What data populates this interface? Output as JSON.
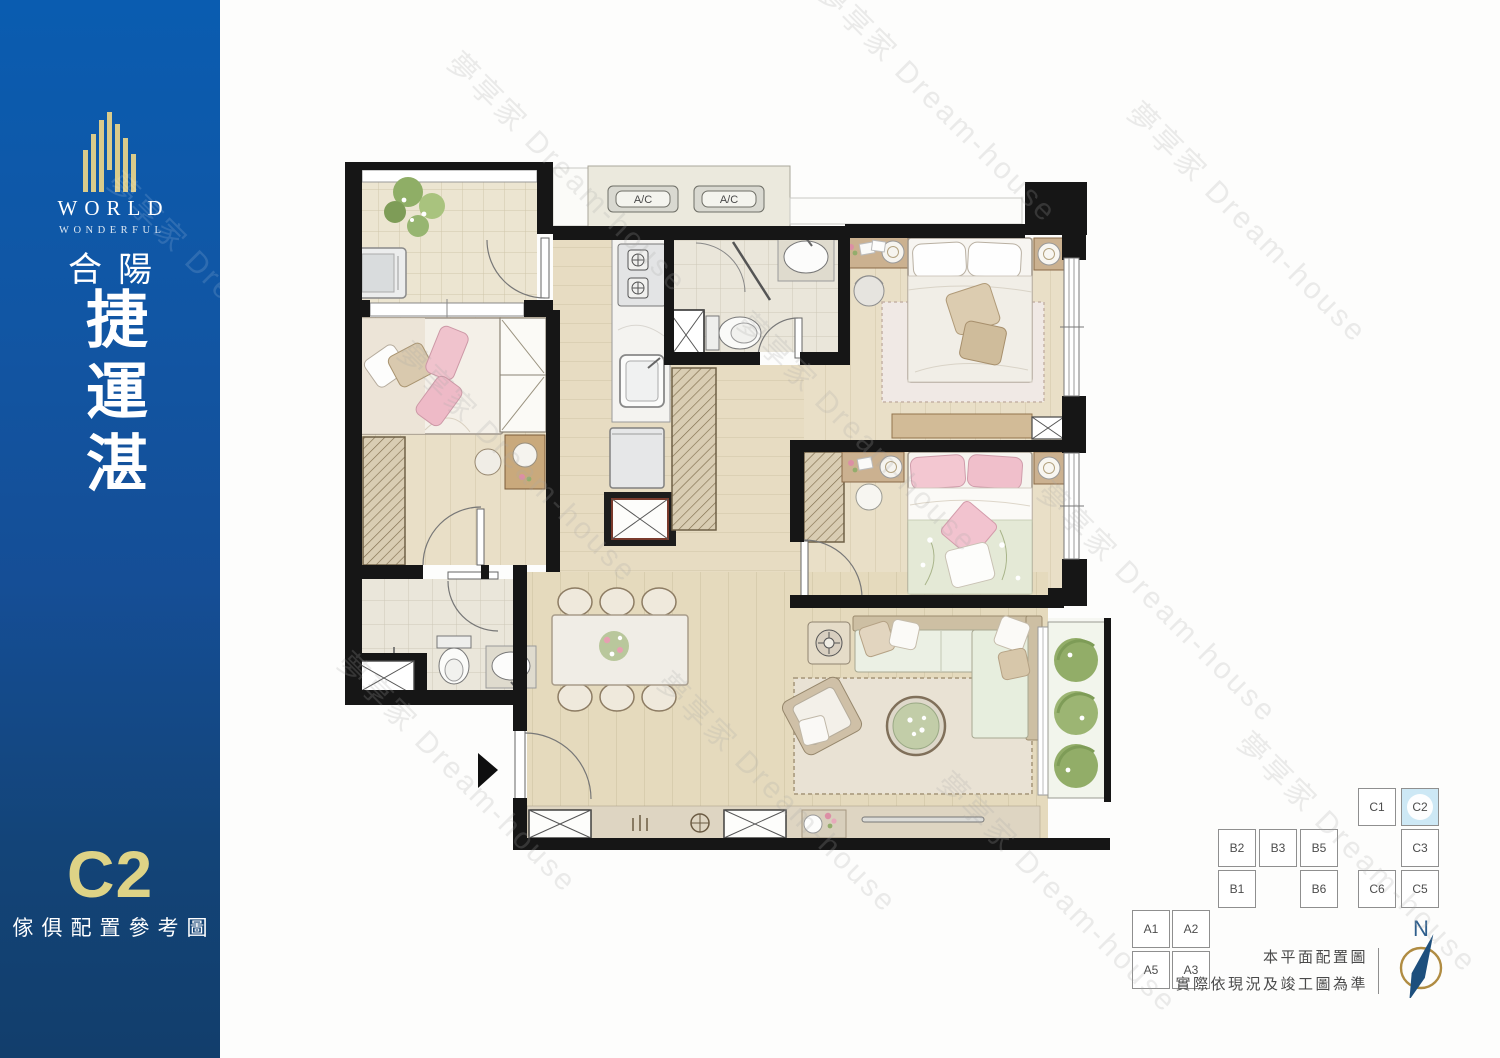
{
  "sidebar": {
    "brand_en_line1": "WORLD",
    "brand_en_line2": "WONDERFUL",
    "brand_cn": "合陽",
    "project_name": "捷運湛",
    "unit_label": "C2",
    "caption": "傢俱配置參考圖"
  },
  "floorplan": {
    "ac_labels": [
      "A/C",
      "A/C"
    ]
  },
  "keyplan": {
    "highlighted_unit": "C2",
    "units": [
      {
        "label": "C1",
        "highlighted": false
      },
      {
        "label": "C2",
        "highlighted": true
      },
      {
        "label": "B2",
        "highlighted": false
      },
      {
        "label": "B3",
        "highlighted": false
      },
      {
        "label": "B5",
        "highlighted": false
      },
      {
        "label": "C3",
        "highlighted": false
      },
      {
        "label": "B1",
        "highlighted": false
      },
      {
        "label": "B6",
        "highlighted": false
      },
      {
        "label": "C6",
        "highlighted": false
      },
      {
        "label": "C5",
        "highlighted": false
      },
      {
        "label": "A1",
        "highlighted": false
      },
      {
        "label": "A2",
        "highlighted": false
      },
      {
        "label": "A5",
        "highlighted": false
      },
      {
        "label": "A3",
        "highlighted": false
      }
    ]
  },
  "footnote": {
    "line1": "本平面配置圖",
    "line2": "實際依現況及竣工圖為準"
  },
  "compass": {
    "north_label": "N"
  },
  "watermark": {
    "text": "夢享家 Dream-house"
  },
  "colors": {
    "sidebar_top": "#0a5cb0",
    "sidebar_bottom": "#123e6c",
    "accent_gold": "#ded386",
    "keyplan_highlight": "#cde8f5",
    "wall_black": "#161616",
    "floor_beige": "#e7dcc2",
    "compass_ring_gold": "#b08c42",
    "compass_needle_blue": "#1d4f7d"
  }
}
